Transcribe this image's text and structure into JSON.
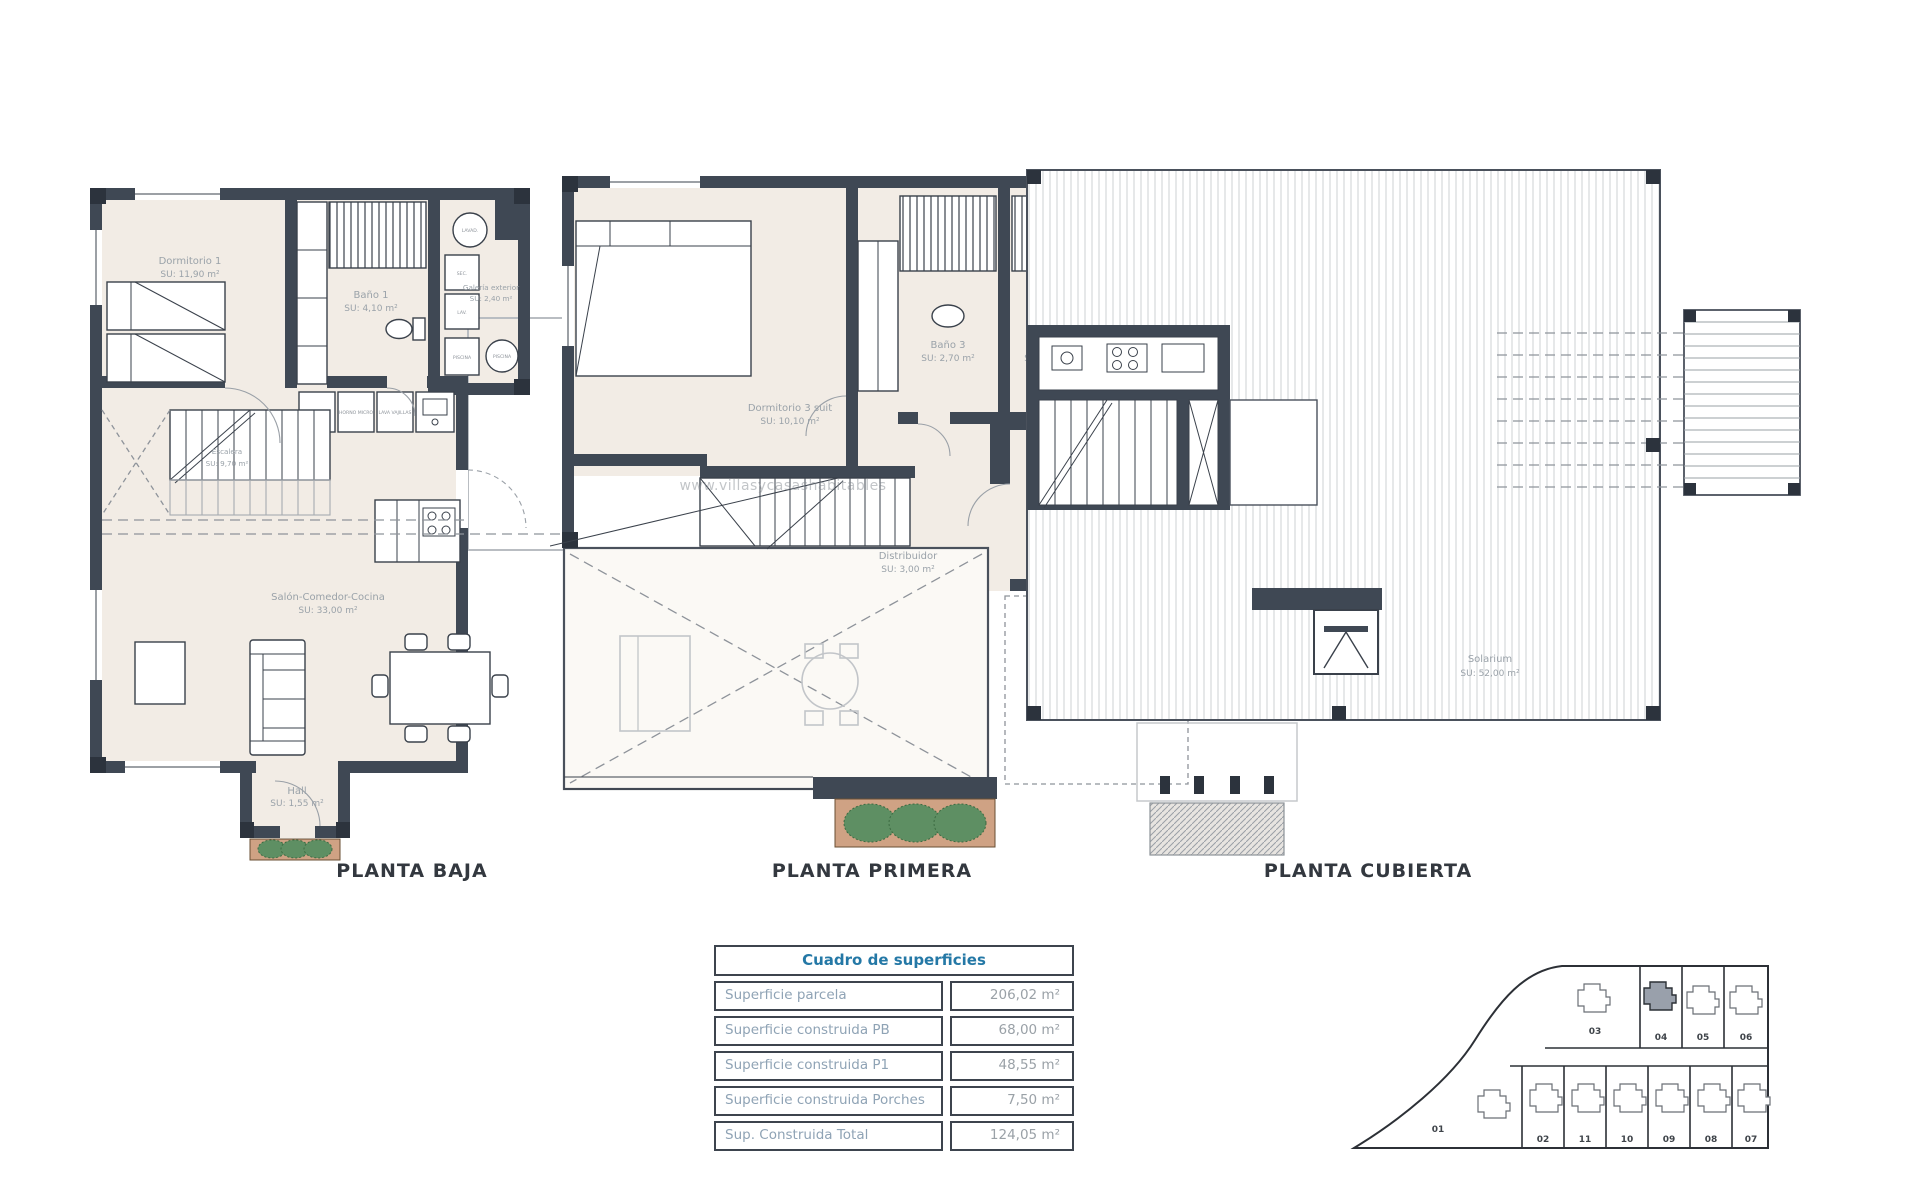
{
  "document": {
    "background": "#ffffff"
  },
  "colors": {
    "bg": "#ffffff",
    "wall": "#3f4854",
    "floor": "#f2ece5",
    "title": "#33383f",
    "label": "#9aa2a9",
    "table_header": "#2478a6",
    "table_label": "#8fa3b5",
    "table_value": "#9aa1a7",
    "plant": "#5e8f63",
    "planter_soil": "#cfa284",
    "site_fill": "#99a0ab"
  },
  "plans": {
    "baja": {
      "title": "PLANTA BAJA",
      "rooms": {
        "dormitorio1": {
          "name": "Dormitorio 1",
          "area": "SU: 11,90 m²"
        },
        "bano1": {
          "name": "Baño 1",
          "area": "SU: 4,10 m²"
        },
        "galeria": {
          "name": "Galería exterior",
          "area": "SU: 2,40 m²"
        },
        "escalera": {
          "name": "Escalera",
          "area": "SU: 9,70 m²"
        },
        "salon": {
          "name": "Salón-Comedor-Cocina",
          "area": "SU: 33,00 m²"
        },
        "hall": {
          "name": "Hall",
          "area": "SU: 1,55 m²"
        }
      },
      "appliances": {
        "frigo": "FRIGO",
        "horno": "HORNO MICRO",
        "lavavajillas": "LAVA VAJILLAS",
        "lavadora": "LAVAD.",
        "secadora": "SEC.",
        "lavadero": "LAV.",
        "piscina1": "PISCINA",
        "piscina2": "PISCINA"
      }
    },
    "primera": {
      "title": "PLANTA PRIMERA",
      "rooms": {
        "dormitorio3": {
          "name": "Dormitorio 3 suit",
          "area": "SU: 10,10 m²"
        },
        "bano3": {
          "name": "Baño 3",
          "area": "SU: 2,70 m²"
        },
        "bano2": {
          "name": "Baño 2",
          "area": "SU: 2,90 m²"
        },
        "dormitorio2": {
          "name": "Dormitorio 2 suit",
          "area": "SU: 10,45 m²"
        },
        "distribuidor": {
          "name": "Distribuidor",
          "area": "SU: 3,00 m²"
        }
      }
    },
    "cubierta": {
      "title": "PLANTA CUBIERTA",
      "rooms": {
        "solarium": {
          "name": "Solarium",
          "area": "SU: 52,00 m²"
        }
      }
    }
  },
  "watermark": {
    "text": "www.villasycasashabitables"
  },
  "surface_table": {
    "header": "Cuadro de superficies",
    "rows": [
      {
        "label": "Superficie parcela",
        "value": "206,02 m²"
      },
      {
        "label": "Superficie construida PB",
        "value": "68,00 m²"
      },
      {
        "label": "Superficie construida P1",
        "value": "48,55 m²"
      },
      {
        "label": "Superficie construida Porches",
        "value": "7,50 m²"
      },
      {
        "label": "Sup. Construida Total",
        "value": "124,05 m²"
      }
    ]
  },
  "site_plan": {
    "highlighted_plot": "04",
    "plots": {
      "p01": "01",
      "p02": "02",
      "p03": "03",
      "p04": "04",
      "p05": "05",
      "p06": "06",
      "p07": "07",
      "p08": "08",
      "p09": "09",
      "p10": "10",
      "p11": "11"
    }
  }
}
